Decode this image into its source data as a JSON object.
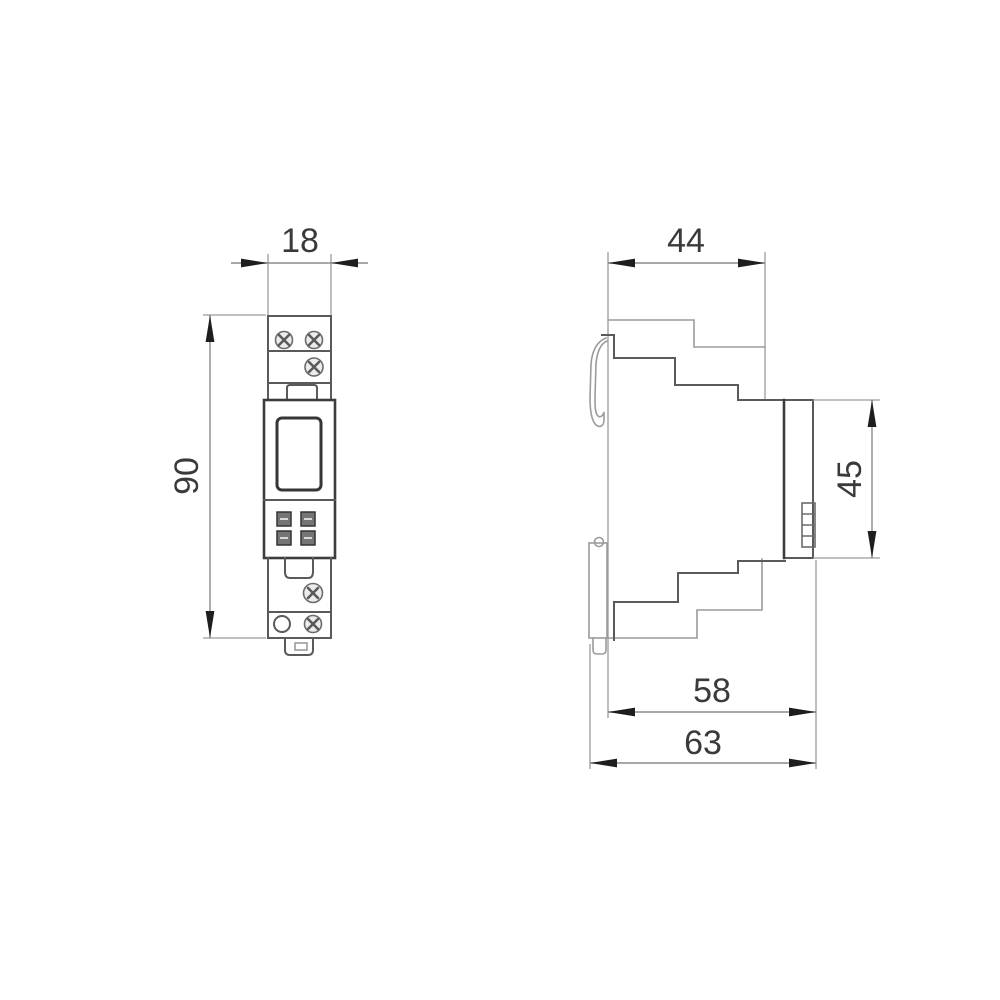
{
  "drawing": {
    "kind": "din-rail-device-dimension-drawing",
    "views": {
      "front": {
        "width": "18",
        "height": "90"
      },
      "side": {
        "housing_depth": "44",
        "panel_height": "45",
        "mount_depth": "58",
        "overall_depth": "63"
      }
    },
    "colors": {
      "background": "#ffffff",
      "line_light": "#9b9b9b",
      "line_dark": "#5a5a5a",
      "outline": "#3d3d3d",
      "dimension_line": "#8c8c8c",
      "arrow": "#1e1e1e",
      "text": "#3a3a3a"
    }
  }
}
